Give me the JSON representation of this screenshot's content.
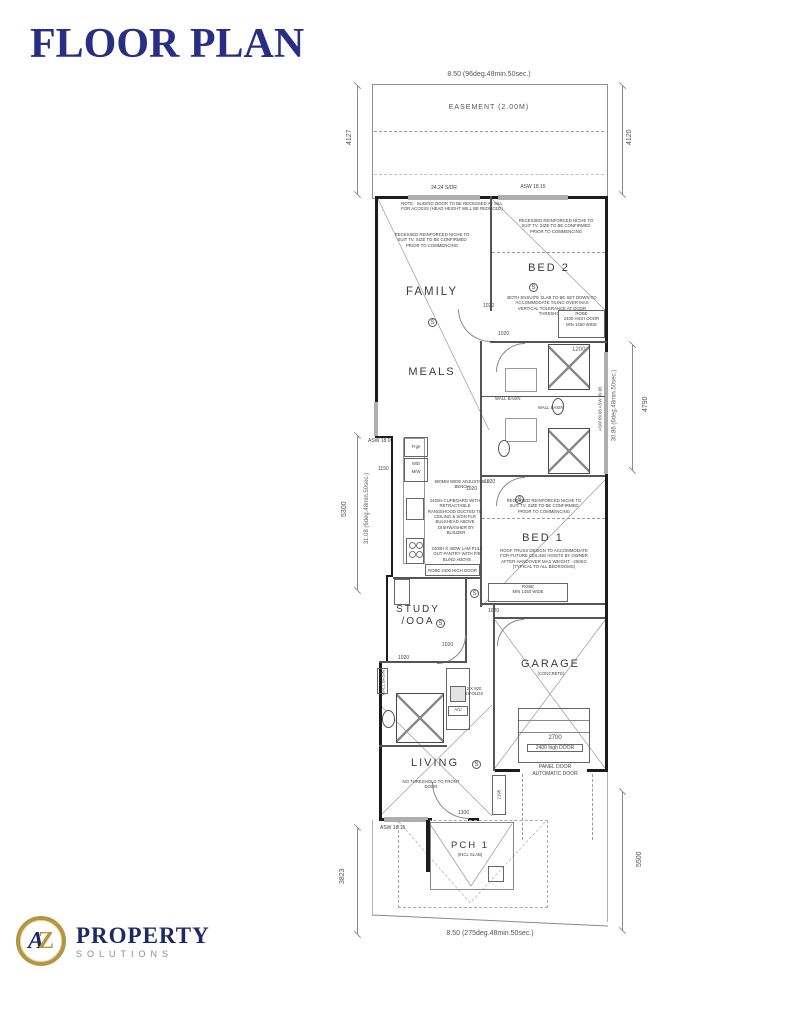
{
  "header": {
    "title": "FLOOR PLAN"
  },
  "logo": {
    "a": "A",
    "z": "Z",
    "name": "PROPERTY",
    "subtitle": "SOLUTIONS"
  },
  "boundaries": {
    "top": "8.50 (96deg.48min.50sec.)",
    "bottom": "8.50 (275deg.48min.50sec.)",
    "easement": "EASEMENT (2.00M)"
  },
  "dims": {
    "left_top": "4127",
    "right_top": "4120",
    "left_mid": "5300",
    "left_mid_len": "31.08 (6deg.48min.50sec.)",
    "right_mid": "4790",
    "right_mid_len": "30.86 (6deg.48min.50sec.)",
    "left_bottom": "3823",
    "right_bottom": "5500",
    "d1020": "1020",
    "d1150": "1150",
    "d1200": "1200",
    "d1300": "1300",
    "d2195": "2195"
  },
  "openings": {
    "slider_top": "24.24 S/DR",
    "window_top": "ASW 18.15",
    "window_left": "ASW 18.06",
    "window_right": "ASW 09.06 ASW 09.06",
    "window_front": "ASW 18.15",
    "bifolds_1": "2 X 920",
    "bifolds_2": "BIFOLDS"
  },
  "rooms": {
    "family": "FAMILY",
    "meals": "MEALS",
    "bed2": "BED 2",
    "bed1": "BED 1",
    "study_1": "STUDY",
    "study_2": "/OOA",
    "garage": "GARAGE",
    "garage_sub": "(CONCRETE)",
    "living": "LIVING",
    "porch": "PCH 1",
    "porch_sub": "(INCL SLAB)"
  },
  "garage_door": {
    "width": "2700",
    "height": "2400 high DOOR",
    "type_1": "PANEL DOOR",
    "type_2": "AUTOMATIC DOOR"
  },
  "fixtures": {
    "fridge": "Frge",
    "wd": "W/D",
    "mw": "M/W",
    "unit": "A/U",
    "wall_basin": "WALL BASIN",
    "robe_small": "ROBE",
    "robe_door": "2400 HIGH DOOR",
    "robe_min": "MIN 1450 WIDE",
    "robe_kitchen": "ROBE 2400 HIGH DOOR",
    "symbol": "S"
  },
  "notes": {
    "sliding": "NOTE : SLIDING DOOR TO BE RECESSED AT SILL FOR ACCESS (HEAD HEIGHT WILL BE REDUCED)",
    "tv": "RECESSED REINFORCED NICHE TO SUIT TV. SIZE TO BE CONFIRMED PRIOR TO COMMENCING",
    "slab": "BOTH ENSUITE SLAB TO BE SET DOWN TO ACCOMMODATE TILING OVER MAX VERTICAL TOLERANCE AT DOOR THRESHOLD",
    "truss": "ROOF TRUSS DESIGN TO ACCOMMODATE FOR FUTURE CEILING HOISTS BY OWNER AFTER HANDOVER MAX WEIGHT - 250KG (TYPICAL TO ALL BEDROOMS)",
    "bench": "900MM WIDE ADJUSTABLE BENCH",
    "rangehood": "2400H CUPBOARD WITH RETRACTABLE RANGEHOOD DUCTED TO CEILING & S/DN FLR BULKHEAD ABOVE",
    "dishwasher": "DISHWASHER BY BUILDER",
    "pantry": "2400H X 300W LAM PULL OUT PANTRY WITH P/B BLIND ABOVE",
    "threshold": "NO THRESHOLD TO FRONT DOOR"
  },
  "colors": {
    "title": "#272f85",
    "gold": "#b6953f",
    "navy": "#1e2864",
    "line": "#444444"
  }
}
